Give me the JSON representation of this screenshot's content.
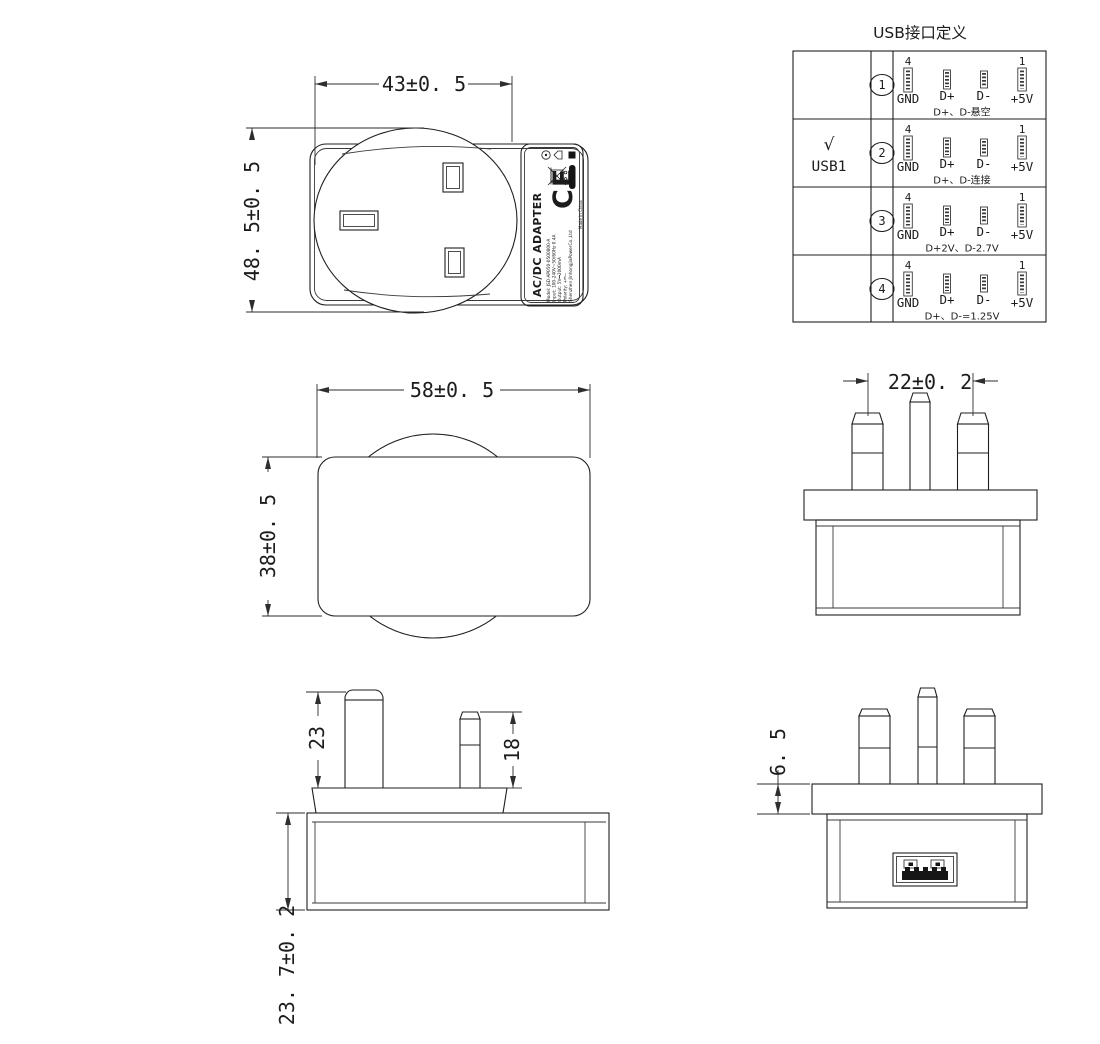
{
  "drawing": {
    "front_view": {
      "width_dim": "43±0. 5",
      "height_dim": "48. 5±0. 5"
    },
    "back_view": {
      "width_dim": "58±0. 5",
      "height_dim": "38±0. 5"
    },
    "pin_front_view": {
      "pitch_dim": "22±0. 2"
    },
    "pin_side_view": {
      "earth_pin_dim": "23",
      "line_pin_dim": "18",
      "depth_dim": "23. 7±0. 2"
    },
    "bottom_view": {
      "flange_dim": "6. 5"
    }
  },
  "label": {
    "product": "AC/DC ADAPTER",
    "model_line": "Model: JSD-AP050-0500800-A",
    "input_line": "Input: 100-240V~50/60Hz 0.4A",
    "output_line": "Output: 5V⎓2000mA",
    "polarity_line": "Polarity: +⎓−",
    "company_line": "Shenzhen JinhongjiaPowerCo.,Ltd",
    "ce_mark": "CE",
    "made_in": "Made in China"
  },
  "usb_table": {
    "title": "USB接口定义",
    "check_mark": "√",
    "checked_port": "USB1",
    "pin_num_left": "4",
    "pin_num_right": "1",
    "pins": [
      "GND",
      "D+",
      "D-",
      "+5V"
    ],
    "rows": [
      {
        "num": "1",
        "note": "D+、D-悬空"
      },
      {
        "num": "2",
        "note": "D+、D-连接"
      },
      {
        "num": "3",
        "note": "D+2V、D-2.7V"
      },
      {
        "num": "4",
        "note": "D+、D-=1.25V"
      }
    ]
  }
}
